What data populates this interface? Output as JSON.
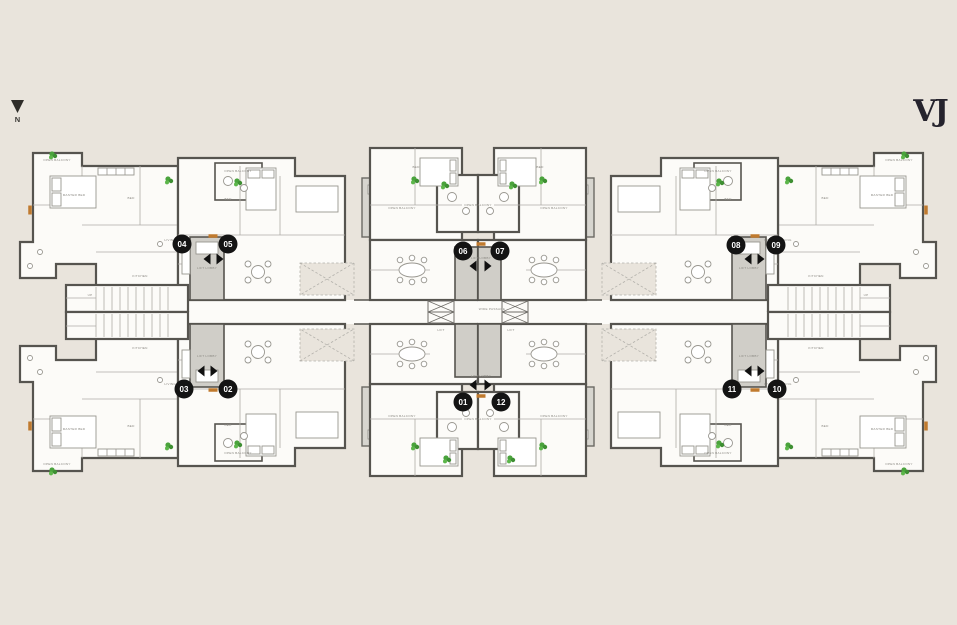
{
  "meta": {
    "brand": "VJ",
    "north_label": "N"
  },
  "plan": {
    "colors": {
      "bg": "#e9e4dc",
      "wall": "#56544f",
      "room": "#fcfbf8",
      "deck": "#d7d5cf",
      "lobby": "#d0cec8",
      "green": "#4aa33c",
      "orange": "#c07a2e",
      "badge_bg": "#141414",
      "badge_text": "#ffffff",
      "label": "#8b8983",
      "brand": "#25232d"
    },
    "passage_label": "WIDE PASSAGE",
    "room_labels": [
      {
        "text": "OPEN BALCONY",
        "x": 57,
        "y": 161
      },
      {
        "text": "MASTER BED",
        "x": 74,
        "y": 196
      },
      {
        "text": "BED",
        "x": 131,
        "y": 199
      },
      {
        "text": "BED",
        "x": 228,
        "y": 200
      },
      {
        "text": "OPEN BALCONY",
        "x": 238,
        "y": 172
      },
      {
        "text": "LIVING / DINING",
        "x": 178,
        "y": 241
      },
      {
        "text": "OPEN BALCONY",
        "x": 402,
        "y": 209
      },
      {
        "text": "BED",
        "x": 416,
        "y": 168
      },
      {
        "text": "KITCHEN",
        "x": 140,
        "y": 277
      },
      {
        "text": "UP",
        "x": 90,
        "y": 296
      },
      {
        "text": "LIFT LOBBY",
        "x": 207,
        "y": 269
      },
      {
        "text": "OPEN BALCONY",
        "x": 478,
        "y": 206
      },
      {
        "text": "OPEN BALCONY",
        "x": 899,
        "y": 161
      },
      {
        "text": "MASTER BED",
        "x": 882,
        "y": 196
      },
      {
        "text": "BED",
        "x": 825,
        "y": 199
      },
      {
        "text": "BED",
        "x": 728,
        "y": 200
      },
      {
        "text": "OPEN BALCONY",
        "x": 718,
        "y": 172
      },
      {
        "text": "LIVING / DINING",
        "x": 778,
        "y": 241
      },
      {
        "text": "OPEN BALCONY",
        "x": 554,
        "y": 209
      },
      {
        "text": "BED",
        "x": 540,
        "y": 168
      },
      {
        "text": "KITCHEN",
        "x": 816,
        "y": 277
      },
      {
        "text": "UP",
        "x": 866,
        "y": 296
      },
      {
        "text": "LIFT LOBBY",
        "x": 749,
        "y": 269
      },
      {
        "text": "OPEN BALCONY",
        "x": 57,
        "y": 465
      },
      {
        "text": "MASTER BED",
        "x": 74,
        "y": 430
      },
      {
        "text": "BED",
        "x": 131,
        "y": 427
      },
      {
        "text": "BED",
        "x": 228,
        "y": 426
      },
      {
        "text": "OPEN BALCONY",
        "x": 238,
        "y": 454
      },
      {
        "text": "LIVING / DINING",
        "x": 178,
        "y": 385
      },
      {
        "text": "OPEN BALCONY",
        "x": 402,
        "y": 417
      },
      {
        "text": "KITCHEN",
        "x": 140,
        "y": 349
      },
      {
        "text": "LIFT LOBBY",
        "x": 207,
        "y": 357
      },
      {
        "text": "OPEN BALCONY",
        "x": 478,
        "y": 420
      },
      {
        "text": "OPEN BALCONY",
        "x": 899,
        "y": 465
      },
      {
        "text": "MASTER BED",
        "x": 882,
        "y": 430
      },
      {
        "text": "BED",
        "x": 825,
        "y": 427
      },
      {
        "text": "BED",
        "x": 728,
        "y": 426
      },
      {
        "text": "OPEN BALCONY",
        "x": 718,
        "y": 454
      },
      {
        "text": "LIVING / DINING",
        "x": 778,
        "y": 385
      },
      {
        "text": "OPEN BALCONY",
        "x": 554,
        "y": 417
      },
      {
        "text": "KITCHEN",
        "x": 816,
        "y": 349
      },
      {
        "text": "LIFT LOBBY",
        "x": 749,
        "y": 357
      },
      {
        "text": "WIDE PASSAGE",
        "x": 492,
        "y": 310
      },
      {
        "text": "LIFT",
        "x": 441,
        "y": 331
      },
      {
        "text": "LIFT",
        "x": 511,
        "y": 331
      },
      {
        "text": "LIFT LOBBY",
        "x": 481,
        "y": 259
      },
      {
        "text": "LIFT LOBBY",
        "x": 481,
        "y": 377
      }
    ],
    "arrows": [
      {
        "x": 207,
        "y": 259,
        "dir": "left"
      },
      {
        "x": 220,
        "y": 259,
        "dir": "right"
      },
      {
        "x": 473,
        "y": 266,
        "dir": "left"
      },
      {
        "x": 488,
        "y": 266,
        "dir": "right"
      },
      {
        "x": 748,
        "y": 259,
        "dir": "left"
      },
      {
        "x": 761,
        "y": 259,
        "dir": "right"
      },
      {
        "x": 201,
        "y": 371,
        "dir": "left"
      },
      {
        "x": 214,
        "y": 371,
        "dir": "right"
      },
      {
        "x": 473,
        "y": 385,
        "dir": "left"
      },
      {
        "x": 488,
        "y": 385,
        "dir": "right"
      },
      {
        "x": 748,
        "y": 371,
        "dir": "left"
      },
      {
        "x": 761,
        "y": 371,
        "dir": "right"
      }
    ],
    "door_markers": [
      {
        "x": 30,
        "y": 210,
        "vertical": true
      },
      {
        "x": 926,
        "y": 210,
        "vertical": true
      },
      {
        "x": 30,
        "y": 426,
        "vertical": true
      },
      {
        "x": 926,
        "y": 426,
        "vertical": true
      },
      {
        "x": 213,
        "y": 236,
        "vertical": false
      },
      {
        "x": 755,
        "y": 236,
        "vertical": false
      },
      {
        "x": 481,
        "y": 244,
        "vertical": false
      },
      {
        "x": 213,
        "y": 390,
        "vertical": false
      },
      {
        "x": 755,
        "y": 390,
        "vertical": false
      },
      {
        "x": 481,
        "y": 396,
        "vertical": false
      }
    ],
    "plants": [
      {
        "x": 52,
        "y": 154
      },
      {
        "x": 168,
        "y": 179
      },
      {
        "x": 237,
        "y": 181
      },
      {
        "x": 414,
        "y": 179
      },
      {
        "x": 444,
        "y": 184
      },
      {
        "x": 904,
        "y": 154
      },
      {
        "x": 788,
        "y": 179
      },
      {
        "x": 719,
        "y": 181
      },
      {
        "x": 542,
        "y": 179
      },
      {
        "x": 512,
        "y": 184
      },
      {
        "x": 52,
        "y": 470
      },
      {
        "x": 168,
        "y": 445
      },
      {
        "x": 237,
        "y": 443
      },
      {
        "x": 414,
        "y": 445
      },
      {
        "x": 446,
        "y": 458
      },
      {
        "x": 904,
        "y": 470
      },
      {
        "x": 788,
        "y": 445
      },
      {
        "x": 719,
        "y": 443
      },
      {
        "x": 542,
        "y": 445
      },
      {
        "x": 510,
        "y": 458
      }
    ]
  },
  "units": [
    {
      "number": "04",
      "x": 182,
      "y": 244
    },
    {
      "number": "05",
      "x": 228,
      "y": 244
    },
    {
      "number": "06",
      "x": 463,
      "y": 251
    },
    {
      "number": "07",
      "x": 500,
      "y": 251
    },
    {
      "number": "08",
      "x": 736,
      "y": 245
    },
    {
      "number": "09",
      "x": 776,
      "y": 245
    },
    {
      "number": "03",
      "x": 184,
      "y": 389
    },
    {
      "number": "02",
      "x": 228,
      "y": 389
    },
    {
      "number": "01",
      "x": 463,
      "y": 402
    },
    {
      "number": "12",
      "x": 501,
      "y": 402
    },
    {
      "number": "11",
      "x": 732,
      "y": 389
    },
    {
      "number": "10",
      "x": 777,
      "y": 389
    }
  ]
}
